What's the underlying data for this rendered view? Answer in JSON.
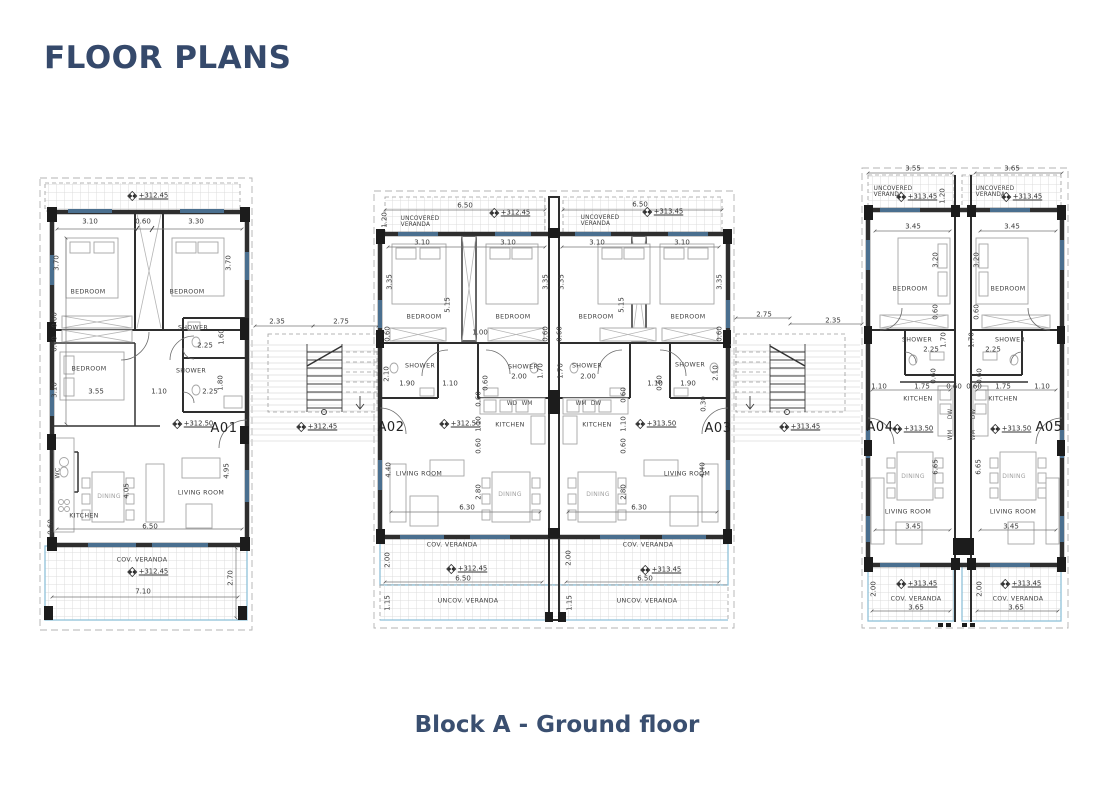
{
  "page": {
    "title": "FLOOR PLANS",
    "caption": "Block A - Ground floor"
  },
  "colors": {
    "accent": "#35496b",
    "wall": "#2e2e2e",
    "veranda_border": "#8fc1d9",
    "window": "#4a6f8f"
  },
  "units": [
    {
      "id": "A01",
      "floor_level": "+312.50",
      "veranda_level": "+312.45"
    },
    {
      "id": "A02",
      "floor_level": "+312.50",
      "veranda_level": "+312.45"
    },
    {
      "id": "A03",
      "floor_level": "+313.50",
      "veranda_level": "+313.45"
    },
    {
      "id": "A04",
      "floor_level": "+313.50",
      "veranda_level": "+313.45"
    },
    {
      "id": "A05",
      "floor_level": "+313.50",
      "veranda_level": "+313.45"
    }
  ],
  "plan": {
    "labels": [
      {
        "t": "3.10",
        "x": 90,
        "y": 222
      },
      {
        "t": "0.60",
        "x": 143,
        "y": 222
      },
      {
        "t": "3.30",
        "x": 196,
        "y": 222
      },
      {
        "t": "3.70",
        "x": 57,
        "y": 263,
        "r": -90
      },
      {
        "t": "3.70",
        "x": 229,
        "y": 263,
        "r": -90
      },
      {
        "t": "0.60",
        "x": 55,
        "y": 320,
        "r": -90
      },
      {
        "t": "0.60",
        "x": 55,
        "y": 344,
        "r": -90
      },
      {
        "t": "3.10",
        "x": 55,
        "y": 390,
        "r": -90
      },
      {
        "t": "2.25",
        "x": 205,
        "y": 346
      },
      {
        "t": "1.60",
        "x": 222,
        "y": 337,
        "r": -90
      },
      {
        "t": "1.80",
        "x": 221,
        "y": 383,
        "r": -90
      },
      {
        "t": "3.55",
        "x": 96,
        "y": 392
      },
      {
        "t": "1.10",
        "x": 159,
        "y": 392
      },
      {
        "t": "2.25",
        "x": 210,
        "y": 392
      },
      {
        "t": "4.05",
        "x": 127,
        "y": 491,
        "r": -90
      },
      {
        "t": "4.95",
        "x": 227,
        "y": 471,
        "r": -90
      },
      {
        "t": "0.60",
        "x": 51,
        "y": 527,
        "r": -90
      },
      {
        "t": "6.50",
        "x": 150,
        "y": 527
      },
      {
        "t": "7.10",
        "x": 143,
        "y": 592
      },
      {
        "t": "2.70",
        "x": 231,
        "y": 578,
        "r": -90
      },
      {
        "t": "2.35",
        "x": 277,
        "y": 322
      },
      {
        "t": "2.75",
        "x": 341,
        "y": 322
      },
      {
        "t": "BEDROOM",
        "x": 88,
        "y": 293,
        "c": "room"
      },
      {
        "t": "BEDROOM",
        "x": 187,
        "y": 293,
        "c": "room"
      },
      {
        "t": "BEDROOM",
        "x": 89,
        "y": 370,
        "c": "room"
      },
      {
        "t": "SHOWER",
        "x": 193,
        "y": 329,
        "c": "room"
      },
      {
        "t": "SHOWER",
        "x": 191,
        "y": 372,
        "c": "room"
      },
      {
        "t": "KITCHEN",
        "x": 84,
        "y": 517,
        "c": "room"
      },
      {
        "t": "LIVING ROOM",
        "x": 201,
        "y": 494,
        "c": "room"
      },
      {
        "t": "DINING",
        "x": 109,
        "y": 497,
        "c": "room-light"
      },
      {
        "t": "WC",
        "x": 59,
        "y": 473,
        "r": -90,
        "c": "room"
      },
      {
        "t": "COV. VERANDA",
        "x": 142,
        "y": 561,
        "c": "room"
      },
      {
        "t": "+312.45",
        "x": 148,
        "y": 196,
        "c": "level"
      },
      {
        "t": "+312.50",
        "x": 193,
        "y": 424,
        "c": "level"
      },
      {
        "t": "+312.45",
        "x": 148,
        "y": 572,
        "c": "level"
      },
      {
        "t": "+312.45",
        "x": 317,
        "y": 427,
        "c": "level"
      },
      {
        "t": "A01",
        "x": 224,
        "y": 429,
        "c": "unit"
      },
      {
        "t": "6.50",
        "x": 465,
        "y": 206
      },
      {
        "t": "1.20",
        "x": 385,
        "y": 220,
        "r": -90
      },
      {
        "t": "3.10",
        "x": 422,
        "y": 243
      },
      {
        "t": "3.10",
        "x": 508,
        "y": 243
      },
      {
        "t": "3.35",
        "x": 390,
        "y": 282,
        "r": -90
      },
      {
        "t": "3.35",
        "x": 546,
        "y": 282,
        "r": -90
      },
      {
        "t": "5.15",
        "x": 448,
        "y": 305,
        "r": -90
      },
      {
        "t": "0.60",
        "x": 388,
        "y": 334,
        "r": -90
      },
      {
        "t": "1.00",
        "x": 480,
        "y": 333
      },
      {
        "t": "0.60",
        "x": 546,
        "y": 334,
        "r": -90
      },
      {
        "t": "2.10",
        "x": 387,
        "y": 374,
        "r": -90
      },
      {
        "t": "1.90",
        "x": 407,
        "y": 384
      },
      {
        "t": "1.10",
        "x": 450,
        "y": 384
      },
      {
        "t": "0.60",
        "x": 486,
        "y": 383,
        "r": -90
      },
      {
        "t": "2.00",
        "x": 519,
        "y": 377
      },
      {
        "t": "1.70",
        "x": 541,
        "y": 371,
        "r": -90
      },
      {
        "t": "0.60",
        "x": 479,
        "y": 399,
        "r": -90
      },
      {
        "t": "1.10",
        "x": 479,
        "y": 424,
        "r": -90
      },
      {
        "t": "0.60",
        "x": 479,
        "y": 446,
        "r": -90
      },
      {
        "t": "4.40",
        "x": 389,
        "y": 470,
        "r": -90
      },
      {
        "t": "2.80",
        "x": 479,
        "y": 492,
        "r": -90
      },
      {
        "t": "6.30",
        "x": 467,
        "y": 508
      },
      {
        "t": "2.00",
        "x": 388,
        "y": 560,
        "r": -90
      },
      {
        "t": "6.50",
        "x": 463,
        "y": 579
      },
      {
        "t": "1.15",
        "x": 388,
        "y": 603,
        "r": -90
      },
      {
        "t": "UNCOVERED\nVERANDA",
        "x": 420,
        "y": 222,
        "c": "veranda2"
      },
      {
        "t": "BEDROOM",
        "x": 424,
        "y": 318,
        "c": "room"
      },
      {
        "t": "BEDROOM",
        "x": 513,
        "y": 318,
        "c": "room"
      },
      {
        "t": "SHOWER",
        "x": 420,
        "y": 367,
        "c": "room"
      },
      {
        "t": "SHOWER",
        "x": 523,
        "y": 368,
        "c": "room"
      },
      {
        "t": "WD",
        "x": 512,
        "y": 404,
        "c": "room-s"
      },
      {
        "t": "WM",
        "x": 527,
        "y": 404,
        "c": "room-s"
      },
      {
        "t": "KITCHEN",
        "x": 510,
        "y": 426,
        "c": "room"
      },
      {
        "t": "LIVING ROOM",
        "x": 419,
        "y": 475,
        "c": "room"
      },
      {
        "t": "DINING",
        "x": 510,
        "y": 495,
        "c": "room-light"
      },
      {
        "t": "COV. VERANDA",
        "x": 452,
        "y": 546,
        "c": "room"
      },
      {
        "t": "UNCOV. VERANDA",
        "x": 468,
        "y": 602,
        "c": "room"
      },
      {
        "t": "+312.45",
        "x": 510,
        "y": 213,
        "c": "level"
      },
      {
        "t": "+312.50",
        "x": 460,
        "y": 424,
        "c": "level"
      },
      {
        "t": "+312.45",
        "x": 467,
        "y": 569,
        "c": "level"
      },
      {
        "t": "A02",
        "x": 391,
        "y": 428,
        "c": "unit"
      },
      {
        "t": "6.50",
        "x": 640,
        "y": 205
      },
      {
        "t": "3.10",
        "x": 597,
        "y": 243
      },
      {
        "t": "3.10",
        "x": 682,
        "y": 243
      },
      {
        "t": "3.35",
        "x": 562,
        "y": 282,
        "r": -90
      },
      {
        "t": "3.35",
        "x": 720,
        "y": 282,
        "r": -90
      },
      {
        "t": "5.15",
        "x": 622,
        "y": 305,
        "r": -90
      },
      {
        "t": "0.60",
        "x": 560,
        "y": 334,
        "r": -90
      },
      {
        "t": "0.60",
        "x": 720,
        "y": 334,
        "r": -90
      },
      {
        "t": "1.70",
        "x": 561,
        "y": 371,
        "r": -90
      },
      {
        "t": "2.00",
        "x": 588,
        "y": 377
      },
      {
        "t": "0.60",
        "x": 660,
        "y": 383,
        "r": -90
      },
      {
        "t": "1.10",
        "x": 655,
        "y": 384
      },
      {
        "t": "1.90",
        "x": 688,
        "y": 384
      },
      {
        "t": "2.10",
        "x": 716,
        "y": 373,
        "r": -90
      },
      {
        "t": "0.30",
        "x": 704,
        "y": 404,
        "r": -90
      },
      {
        "t": "0.60",
        "x": 624,
        "y": 395,
        "r": -90
      },
      {
        "t": "1.10",
        "x": 624,
        "y": 424,
        "r": -90
      },
      {
        "t": "0.60",
        "x": 624,
        "y": 446,
        "r": -90
      },
      {
        "t": "2.80",
        "x": 624,
        "y": 492,
        "r": -90
      },
      {
        "t": "4.40",
        "x": 703,
        "y": 470,
        "r": -90
      },
      {
        "t": "6.30",
        "x": 639,
        "y": 508
      },
      {
        "t": "2.00",
        "x": 569,
        "y": 558,
        "r": -90
      },
      {
        "t": "6.50",
        "x": 645,
        "y": 579
      },
      {
        "t": "1.15",
        "x": 570,
        "y": 603,
        "r": -90
      },
      {
        "t": "2.75",
        "x": 764,
        "y": 315
      },
      {
        "t": "2.35",
        "x": 833,
        "y": 321
      },
      {
        "t": "UNCOVERED\nVERANDA",
        "x": 600,
        "y": 221,
        "c": "veranda2"
      },
      {
        "t": "BEDROOM",
        "x": 596,
        "y": 318,
        "c": "room"
      },
      {
        "t": "BEDROOM",
        "x": 688,
        "y": 318,
        "c": "room"
      },
      {
        "t": "SHOWER",
        "x": 587,
        "y": 367,
        "c": "room"
      },
      {
        "t": "SHOWER",
        "x": 690,
        "y": 366,
        "c": "room"
      },
      {
        "t": "WM",
        "x": 581,
        "y": 404,
        "c": "room-s"
      },
      {
        "t": "DW",
        "x": 596,
        "y": 404,
        "c": "room-s"
      },
      {
        "t": "KITCHEN",
        "x": 597,
        "y": 426,
        "c": "room"
      },
      {
        "t": "LIVING ROOM",
        "x": 687,
        "y": 475,
        "c": "room"
      },
      {
        "t": "DINING",
        "x": 598,
        "y": 495,
        "c": "room-light"
      },
      {
        "t": "COV. VERANDA",
        "x": 648,
        "y": 546,
        "c": "room"
      },
      {
        "t": "UNCOV. VERANDA",
        "x": 647,
        "y": 602,
        "c": "room"
      },
      {
        "t": "+313.45",
        "x": 663,
        "y": 212,
        "c": "level"
      },
      {
        "t": "+313.50",
        "x": 656,
        "y": 424,
        "c": "level"
      },
      {
        "t": "+313.45",
        "x": 661,
        "y": 570,
        "c": "level"
      },
      {
        "t": "+313.45",
        "x": 800,
        "y": 427,
        "c": "level"
      },
      {
        "t": "A03",
        "x": 718,
        "y": 429,
        "c": "unit"
      },
      {
        "t": "3.55",
        "x": 913,
        "y": 169
      },
      {
        "t": "3.65",
        "x": 1012,
        "y": 169
      },
      {
        "t": "1.20",
        "x": 943,
        "y": 196,
        "r": -90
      },
      {
        "t": "3.45",
        "x": 913,
        "y": 227
      },
      {
        "t": "3.45",
        "x": 1012,
        "y": 227
      },
      {
        "t": "3.20",
        "x": 936,
        "y": 260,
        "r": -90
      },
      {
        "t": "3.20",
        "x": 977,
        "y": 260,
        "r": -90
      },
      {
        "t": "0.60",
        "x": 936,
        "y": 312,
        "r": -90
      },
      {
        "t": "0.60",
        "x": 977,
        "y": 312,
        "r": -90
      },
      {
        "t": "1.70",
        "x": 944,
        "y": 340,
        "r": -90
      },
      {
        "t": "1.70",
        "x": 972,
        "y": 340,
        "r": -90
      },
      {
        "t": "2.25",
        "x": 931,
        "y": 350
      },
      {
        "t": "2.25",
        "x": 993,
        "y": 350
      },
      {
        "t": "0.60",
        "x": 934,
        "y": 376,
        "r": -90
      },
      {
        "t": "0.60",
        "x": 980,
        "y": 376,
        "r": -90
      },
      {
        "t": "1.10",
        "x": 879,
        "y": 387
      },
      {
        "t": "1.75",
        "x": 922,
        "y": 387
      },
      {
        "t": "0.60",
        "x": 954,
        "y": 387
      },
      {
        "t": "0.60",
        "x": 974,
        "y": 387
      },
      {
        "t": "1.75",
        "x": 1003,
        "y": 387
      },
      {
        "t": "1.10",
        "x": 1042,
        "y": 387
      },
      {
        "t": "6.65",
        "x": 936,
        "y": 467,
        "r": -90
      },
      {
        "t": "6.65",
        "x": 979,
        "y": 467,
        "r": -90
      },
      {
        "t": "3.45",
        "x": 913,
        "y": 527
      },
      {
        "t": "3.45",
        "x": 1011,
        "y": 527
      },
      {
        "t": "2.00",
        "x": 874,
        "y": 589,
        "r": -90
      },
      {
        "t": "2.00",
        "x": 980,
        "y": 589,
        "r": -90
      },
      {
        "t": "3.65",
        "x": 916,
        "y": 608
      },
      {
        "t": "3.65",
        "x": 1016,
        "y": 608
      },
      {
        "t": "UNCOVERED\nVERANDA",
        "x": 893,
        "y": 192,
        "c": "veranda2"
      },
      {
        "t": "UNCOVERED\nVERANDA",
        "x": 995,
        "y": 192,
        "c": "veranda2"
      },
      {
        "t": "BEDROOM",
        "x": 910,
        "y": 290,
        "c": "room"
      },
      {
        "t": "BEDROOM",
        "x": 1008,
        "y": 290,
        "c": "room"
      },
      {
        "t": "SHOWER",
        "x": 917,
        "y": 341,
        "c": "room"
      },
      {
        "t": "SHOWER",
        "x": 1010,
        "y": 341,
        "c": "room"
      },
      {
        "t": "KITCHEN",
        "x": 918,
        "y": 400,
        "c": "room"
      },
      {
        "t": "KITCHEN",
        "x": 1003,
        "y": 400,
        "c": "room"
      },
      {
        "t": "DW",
        "x": 951,
        "y": 414,
        "r": -90,
        "c": "room-s"
      },
      {
        "t": "WM",
        "x": 951,
        "y": 435,
        "r": -90,
        "c": "room-s"
      },
      {
        "t": "DW",
        "x": 974,
        "y": 414,
        "r": -90,
        "c": "room-s"
      },
      {
        "t": "WM",
        "x": 974,
        "y": 435,
        "r": -90,
        "c": "room-s"
      },
      {
        "t": "DINING",
        "x": 913,
        "y": 477,
        "c": "room-light"
      },
      {
        "t": "DINING",
        "x": 1014,
        "y": 477,
        "c": "room-light"
      },
      {
        "t": "LIVING ROOM",
        "x": 908,
        "y": 513,
        "c": "room"
      },
      {
        "t": "LIVING ROOM",
        "x": 1013,
        "y": 513,
        "c": "room"
      },
      {
        "t": "COV. VERANDA",
        "x": 916,
        "y": 600,
        "c": "room"
      },
      {
        "t": "COV. VERANDA",
        "x": 1018,
        "y": 600,
        "c": "room"
      },
      {
        "t": "+313.45",
        "x": 917,
        "y": 197,
        "c": "level"
      },
      {
        "t": "+313.45",
        "x": 1022,
        "y": 197,
        "c": "level"
      },
      {
        "t": "+313.50",
        "x": 913,
        "y": 429,
        "c": "level"
      },
      {
        "t": "+313.50",
        "x": 1011,
        "y": 429,
        "c": "level"
      },
      {
        "t": "+313.45",
        "x": 917,
        "y": 584,
        "c": "level"
      },
      {
        "t": "+313.45",
        "x": 1021,
        "y": 584,
        "c": "level"
      },
      {
        "t": "A04",
        "x": 880,
        "y": 428,
        "c": "unit"
      },
      {
        "t": "A05",
        "x": 1049,
        "y": 428,
        "c": "unit"
      }
    ]
  }
}
